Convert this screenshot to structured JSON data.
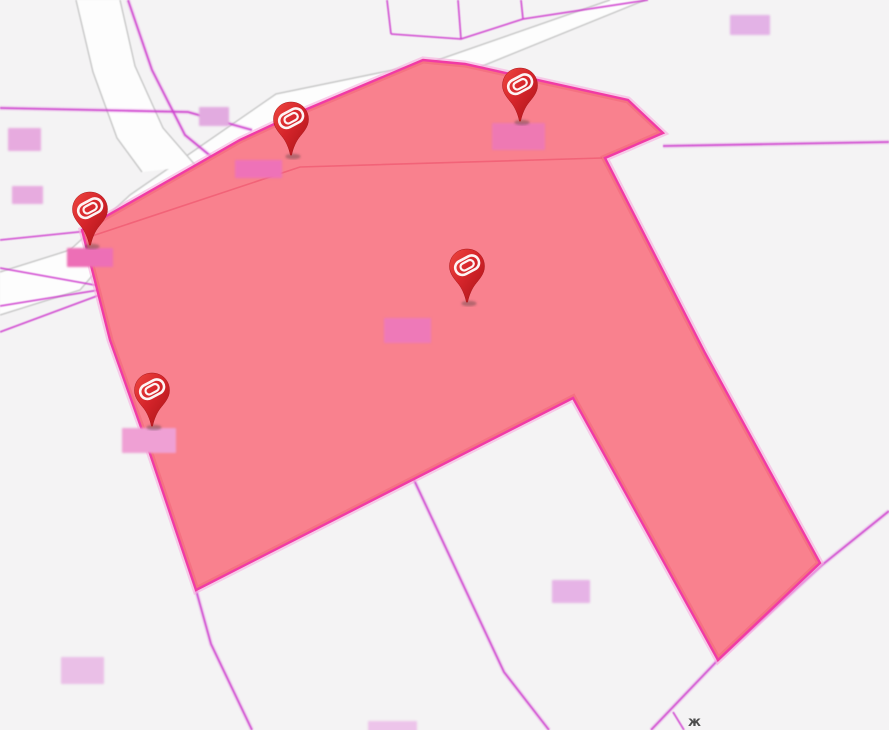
{
  "map_view": {
    "colors": {
      "background": "#f4f3f4",
      "road_fill": "#fdfdfd",
      "road_edge": "#c9c9c9",
      "parcel_line": "#cf3ecf",
      "highlight_fill": "#f9818e",
      "highlight_border": "#f13ba5",
      "highlight_border_halo": "#f7aedd",
      "highlight_inner_shade": "#ef5a70",
      "pin_red": "#d6252b",
      "pin_red_dark": "#a91418",
      "pin_logo_color": "#ffffff",
      "pin_shadow": "rgba(70,60,60,0.38)"
    },
    "markers": [
      {
        "id": "pin-1",
        "x": 291,
        "y": 156
      },
      {
        "id": "pin-2",
        "x": 520,
        "y": 122
      },
      {
        "id": "pin-3",
        "x": 90,
        "y": 246
      },
      {
        "id": "pin-4",
        "x": 467,
        "y": 303
      },
      {
        "id": "pin-5",
        "x": 152,
        "y": 427
      }
    ],
    "marker_icon": "location-pin-with-rounded-ring-logo",
    "redacted_labels": [
      {
        "x": 8,
        "y": 128,
        "w": 33,
        "h": 23,
        "color": "#e7abdf"
      },
      {
        "x": 12,
        "y": 186,
        "w": 31,
        "h": 18,
        "color": "#e7abdf"
      },
      {
        "x": 67,
        "y": 248,
        "w": 46,
        "h": 19,
        "color": "#ed6fb6"
      },
      {
        "x": 199,
        "y": 107,
        "w": 30,
        "h": 19,
        "color": "#e2abe0"
      },
      {
        "x": 235,
        "y": 160,
        "w": 47,
        "h": 18,
        "color": "#ee72b8"
      },
      {
        "x": 492,
        "y": 123,
        "w": 53,
        "h": 27,
        "color": "#ee79b3"
      },
      {
        "x": 384,
        "y": 318,
        "w": 47,
        "h": 25,
        "color": "#ee79b8"
      },
      {
        "x": 122,
        "y": 428,
        "w": 54,
        "h": 25,
        "color": "#efa0d4"
      },
      {
        "x": 552,
        "y": 580,
        "w": 38,
        "h": 23,
        "color": "#e6b3e6"
      },
      {
        "x": 61,
        "y": 657,
        "w": 43,
        "h": 27,
        "color": "#eabfe7"
      },
      {
        "x": 368,
        "y": 721,
        "w": 49,
        "h": 12,
        "color": "#edc4ea"
      },
      {
        "x": 730,
        "y": 15,
        "w": 40,
        "h": 20,
        "color": "#e3b2e6"
      }
    ],
    "partial_text_glyph": {
      "char": "ж",
      "color": "#4d4d4d",
      "x": 688,
      "y": 716
    }
  }
}
